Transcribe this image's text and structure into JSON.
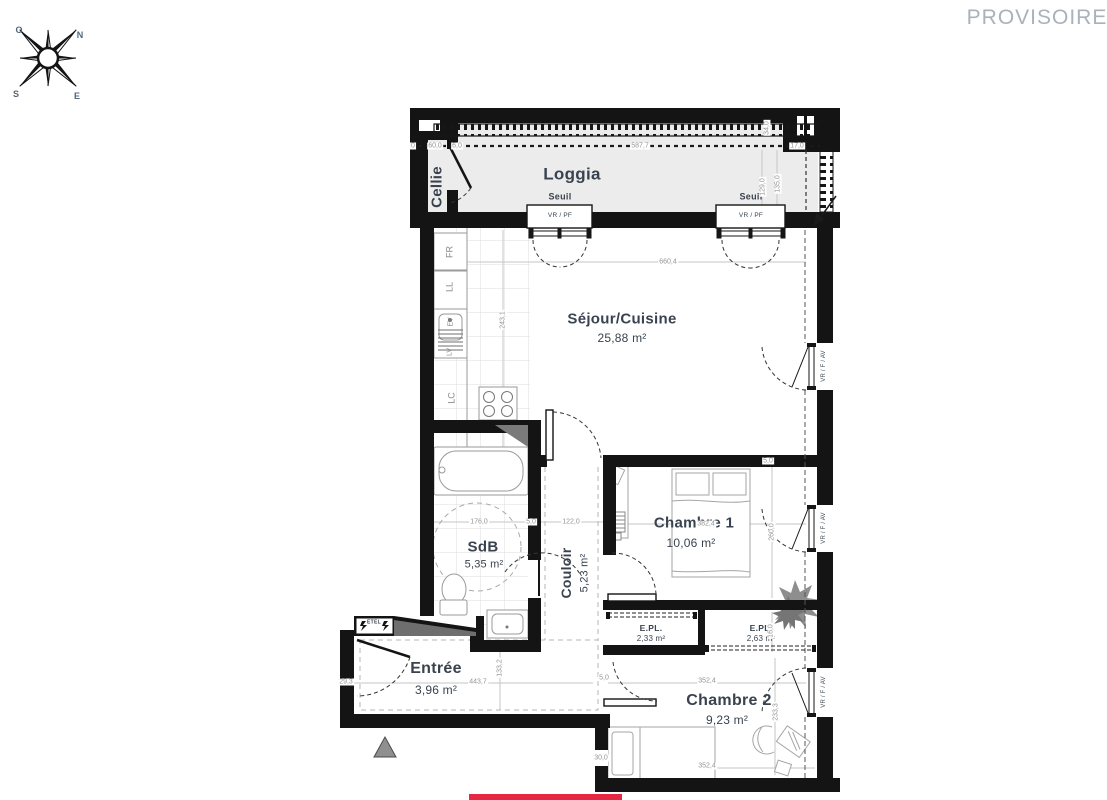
{
  "status": {
    "label": "PROVISOIRE"
  },
  "compass": {
    "n": "N",
    "e": "E",
    "s": "S",
    "o": "O"
  },
  "rooms": {
    "cellier": {
      "name": "Cellie"
    },
    "loggia": {
      "name": "Loggia"
    },
    "sejour": {
      "name": "Séjour/Cuisine",
      "area": "25,88 m²"
    },
    "chambre1": {
      "name": "Chambre 1",
      "area": "10,06 m²"
    },
    "sdb": {
      "name": "SdB",
      "area": "5,35 m²"
    },
    "couloir": {
      "name": "Couloir",
      "area": "5,23 m²"
    },
    "entree": {
      "name": "Entrée",
      "area": "3,96 m²"
    },
    "chambre2": {
      "name": "Chambre 2",
      "area": "9,23 m²"
    },
    "placard1": {
      "name": "E.PL.",
      "area": "2,33 m²"
    },
    "placard2": {
      "name": "E.PL.",
      "area": "2,63 m²"
    }
  },
  "openings": {
    "seuil": "Seuil",
    "vr_pf": "VR / PF",
    "vr_f_av": "VR / F / AV"
  },
  "fixtures": {
    "fr": "FR",
    "ll": "LL",
    "ev": "EV",
    "lv": "LV",
    "lc": "LC",
    "etel": "ETEL"
  },
  "dims": {
    "zero": "0",
    "sixty": "60,0",
    "six": "6,0",
    "l587": "587,7",
    "l17": "17,0",
    "l34": "34,0",
    "l129": "129,0",
    "l135": "135,0",
    "l660": "660,4",
    "l243": "243,1",
    "l176": "176,0",
    "l122": "122,0",
    "l5": "5,0",
    "l382": "382,4",
    "l260": "260,0",
    "l16": "16,0",
    "l443": "443,7",
    "l133": "133,2",
    "l29": "29,3",
    "l352": "352,4",
    "l233": "233,3",
    "l30": "30,0"
  },
  "colors": {
    "wall": "#141414",
    "loggia_fill": "#ececec",
    "label": "#39434f",
    "dim_text": "#949494",
    "accent_red": "#e62744",
    "provisoire": "#a9b1bb"
  }
}
